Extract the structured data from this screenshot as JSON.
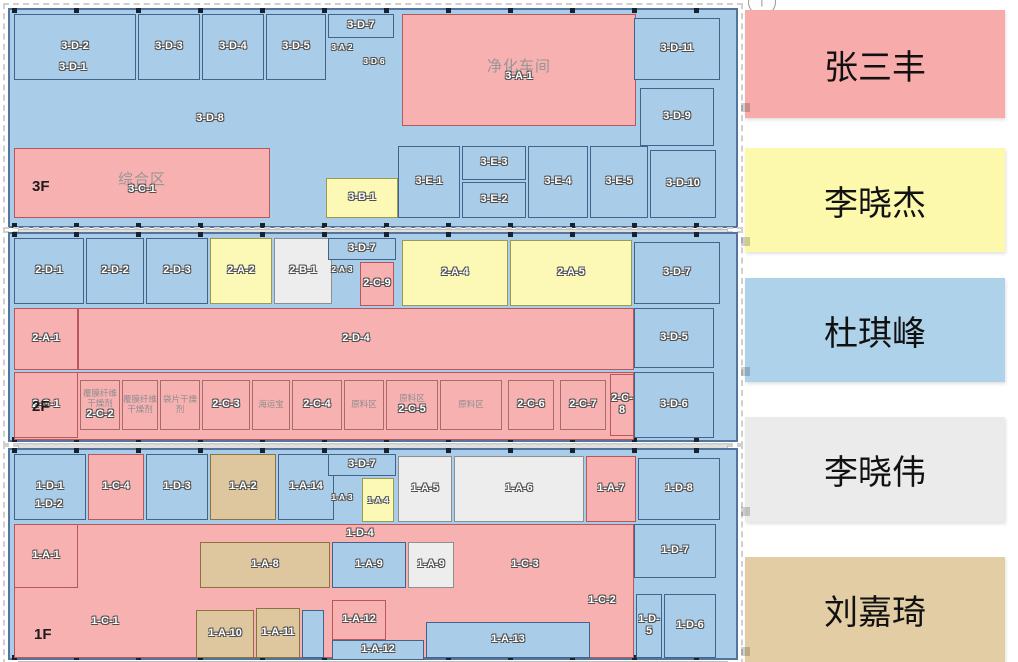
{
  "colors": {
    "pink": {
      "bg": "#f8b1b1",
      "border": "#b5575d"
    },
    "yellow": {
      "bg": "#fbf9b5",
      "border": "#9b9b4f"
    },
    "blue": {
      "bg": "#a9cde9",
      "border": "#41638c"
    },
    "gray": {
      "bg": "#ededed",
      "border": "#8f8f8f"
    },
    "tan": {
      "bg": "#dec69e",
      "border": "#8b7340"
    },
    "pinkbox": {
      "bg": "#f8b1b1",
      "border": "#a96c6c"
    },
    "floor_base": "#a9cde9",
    "wall": "#53759b"
  },
  "legend": {
    "north_arrow": {
      "icon": "north-arrow",
      "glyph": "↑"
    },
    "items": [
      {
        "name": "张三丰",
        "color": "#f8abab",
        "y": 10,
        "h": 108
      },
      {
        "name": "李晓杰",
        "color": "#fcf9ad",
        "y": 148,
        "h": 104
      },
      {
        "name": "杜琪峰",
        "color": "#aed2ea",
        "y": 278,
        "h": 104
      },
      {
        "name": "李晓伟",
        "color": "#ebebeb",
        "y": 417,
        "h": 105
      },
      {
        "name": "刘嘉琦",
        "color": "#e3cda4",
        "y": 557,
        "h": 105
      }
    ]
  },
  "floors": [
    {
      "id": "3F",
      "label": "3F",
      "x": 8,
      "y": 8,
      "w": 730,
      "h": 220,
      "label_x": 22,
      "label_y": 168,
      "rooms": [
        {
          "label": "3-A-1",
          "color": "pink",
          "x": 392,
          "y": 4,
          "w": 234,
          "h": 112,
          "ann": "净化车间",
          "annBig": true
        },
        {
          "label": "3-C-1",
          "color": "pink",
          "x": 4,
          "y": 138,
          "w": 256,
          "h": 70,
          "ann": "综合区",
          "annBig": true
        },
        {
          "label": "3-D-2",
          "color": "blue",
          "x": 4,
          "y": 4,
          "w": 122,
          "h": 66
        },
        {
          "label": "3-D-1",
          "color": "none",
          "x": 18,
          "y": 50,
          "w": 90,
          "h": 16
        },
        {
          "label": "3-D-3",
          "color": "blue",
          "x": 128,
          "y": 4,
          "w": 62,
          "h": 66
        },
        {
          "label": "3-D-4",
          "color": "blue",
          "x": 192,
          "y": 4,
          "w": 62,
          "h": 66
        },
        {
          "label": "3-D-5",
          "color": "blue",
          "x": 256,
          "y": 4,
          "w": 60,
          "h": 66
        },
        {
          "label": "3-D-7",
          "color": "blue",
          "x": 318,
          "y": 4,
          "w": 66,
          "h": 24
        },
        {
          "label": "3-A-2",
          "color": "none",
          "x": 312,
          "y": 30,
          "w": 40,
          "h": 14,
          "small": true
        },
        {
          "label": "3-D-6",
          "color": "none",
          "x": 344,
          "y": 42,
          "w": 40,
          "h": 18,
          "small": true
        },
        {
          "label": "3-D-11",
          "color": "blue",
          "x": 624,
          "y": 8,
          "w": 86,
          "h": 62
        },
        {
          "label": "3-D-8",
          "color": "none",
          "x": 140,
          "y": 100,
          "w": 120,
          "h": 18
        },
        {
          "label": "3-D-9",
          "color": "blue",
          "x": 630,
          "y": 78,
          "w": 74,
          "h": 58
        },
        {
          "label": "3-B-1",
          "color": "yellow",
          "x": 316,
          "y": 168,
          "w": 72,
          "h": 40
        },
        {
          "label": "3-E-1",
          "color": "blue",
          "x": 388,
          "y": 136,
          "w": 62,
          "h": 72
        },
        {
          "label": "3-E-3",
          "color": "blue",
          "x": 452,
          "y": 136,
          "w": 64,
          "h": 34
        },
        {
          "label": "3-E-2",
          "color": "blue",
          "x": 452,
          "y": 172,
          "w": 64,
          "h": 36
        },
        {
          "label": "3-E-4",
          "color": "blue",
          "x": 518,
          "y": 136,
          "w": 60,
          "h": 72
        },
        {
          "label": "3-E-5",
          "color": "blue",
          "x": 580,
          "y": 136,
          "w": 58,
          "h": 72
        },
        {
          "label": "3-D-10",
          "color": "blue",
          "x": 640,
          "y": 140,
          "w": 66,
          "h": 68
        }
      ]
    },
    {
      "id": "2F",
      "label": "2F",
      "x": 8,
      "y": 232,
      "w": 730,
      "h": 210,
      "label_x": 22,
      "label_y": 164,
      "rooms": [
        {
          "label": "",
          "color": "pink",
          "x": 4,
          "y": 74,
          "w": 620,
          "h": 62
        },
        {
          "label": "",
          "color": "pink",
          "x": 4,
          "y": 138,
          "w": 620,
          "h": 68
        },
        {
          "label": "2-D-1",
          "color": "blue",
          "x": 4,
          "y": 4,
          "w": 70,
          "h": 66
        },
        {
          "label": "2-D-2",
          "color": "blue",
          "x": 76,
          "y": 4,
          "w": 58,
          "h": 66
        },
        {
          "label": "2-D-3",
          "color": "blue",
          "x": 136,
          "y": 4,
          "w": 62,
          "h": 66
        },
        {
          "label": "2-A-2",
          "color": "yellow",
          "x": 200,
          "y": 4,
          "w": 62,
          "h": 66
        },
        {
          "label": "2-B-1",
          "color": "gray",
          "x": 264,
          "y": 4,
          "w": 58,
          "h": 66
        },
        {
          "label": "3-D-7",
          "color": "blue",
          "x": 318,
          "y": 4,
          "w": 68,
          "h": 22
        },
        {
          "label": "2-A-3",
          "color": "none",
          "x": 314,
          "y": 28,
          "w": 36,
          "h": 14,
          "small": true
        },
        {
          "label": "2-C-9",
          "color": "pink",
          "x": 350,
          "y": 28,
          "w": 34,
          "h": 44
        },
        {
          "label": "2-A-4",
          "color": "yellow",
          "x": 392,
          "y": 6,
          "w": 106,
          "h": 66
        },
        {
          "label": "2-A-5",
          "color": "yellow",
          "x": 500,
          "y": 6,
          "w": 122,
          "h": 66
        },
        {
          "label": "3-D-7",
          "color": "blue",
          "x": 624,
          "y": 8,
          "w": 86,
          "h": 62
        },
        {
          "label": "2-A-1",
          "color": "pink",
          "x": 4,
          "y": 74,
          "w": 64,
          "h": 62
        },
        {
          "label": "2-D-4",
          "color": "pink",
          "x": 68,
          "y": 74,
          "w": 556,
          "h": 62
        },
        {
          "label": "3-D-5",
          "color": "blue",
          "x": 624,
          "y": 74,
          "w": 80,
          "h": 60
        },
        {
          "label": "2-C-1",
          "color": "pink",
          "x": 4,
          "y": 138,
          "w": 64,
          "h": 66
        },
        {
          "label": "2-C-2",
          "color": "pinkbox",
          "x": 70,
          "y": 146,
          "w": 40,
          "h": 50,
          "ann": "覆膜纤维干燥剂"
        },
        {
          "label": "",
          "color": "pinkbox",
          "x": 112,
          "y": 146,
          "w": 36,
          "h": 50,
          "ann": "覆膜纤维干燥剂"
        },
        {
          "label": "",
          "color": "pinkbox",
          "x": 150,
          "y": 146,
          "w": 40,
          "h": 50,
          "ann": "袋片干燥剂"
        },
        {
          "label": "2-C-3",
          "color": "pinkbox",
          "x": 192,
          "y": 146,
          "w": 48,
          "h": 50
        },
        {
          "label": "",
          "color": "pinkbox",
          "x": 242,
          "y": 146,
          "w": 38,
          "h": 50,
          "ann": "海运宝"
        },
        {
          "label": "2-C-4",
          "color": "pinkbox",
          "x": 282,
          "y": 146,
          "w": 50,
          "h": 50
        },
        {
          "label": "",
          "color": "pinkbox",
          "x": 334,
          "y": 146,
          "w": 40,
          "h": 50,
          "ann": "原料区"
        },
        {
          "label": "2-C-5",
          "color": "pinkbox",
          "x": 376,
          "y": 146,
          "w": 52,
          "h": 50,
          "ann": "原料区"
        },
        {
          "label": "",
          "color": "pinkbox",
          "x": 430,
          "y": 146,
          "w": 62,
          "h": 50,
          "ann": "原料区"
        },
        {
          "label": "2-C-6",
          "color": "pinkbox",
          "x": 498,
          "y": 146,
          "w": 46,
          "h": 50
        },
        {
          "label": "2-C-7",
          "color": "pinkbox",
          "x": 550,
          "y": 146,
          "w": 46,
          "h": 50
        },
        {
          "label": "2-C-8",
          "color": "pink",
          "x": 600,
          "y": 140,
          "w": 24,
          "h": 62
        },
        {
          "label": "3-D-6",
          "color": "blue",
          "x": 624,
          "y": 138,
          "w": 80,
          "h": 66
        }
      ]
    },
    {
      "id": "1F",
      "label": "1F",
      "x": 8,
      "y": 448,
      "w": 730,
      "h": 212,
      "label_x": 24,
      "label_y": 176,
      "rooms": [
        {
          "label": "",
          "color": "pink",
          "x": 4,
          "y": 74,
          "w": 620,
          "h": 134
        },
        {
          "label": "1-D-1",
          "color": "blue",
          "x": 4,
          "y": 4,
          "w": 72,
          "h": 66
        },
        {
          "label": "1-D-2",
          "color": "none",
          "x": 8,
          "y": 46,
          "w": 62,
          "h": 18
        },
        {
          "label": "1-C-4",
          "color": "pink",
          "x": 78,
          "y": 4,
          "w": 56,
          "h": 66
        },
        {
          "label": "1-D-3",
          "color": "blue",
          "x": 136,
          "y": 4,
          "w": 62,
          "h": 66
        },
        {
          "label": "1-A-2",
          "color": "tan",
          "x": 200,
          "y": 4,
          "w": 66,
          "h": 66
        },
        {
          "label": "1-A-14",
          "color": "blue",
          "x": 268,
          "y": 4,
          "w": 56,
          "h": 66
        },
        {
          "label": "3-D-7",
          "color": "blue",
          "x": 318,
          "y": 4,
          "w": 68,
          "h": 22
        },
        {
          "label": "1-A-3",
          "color": "none",
          "x": 314,
          "y": 40,
          "w": 36,
          "h": 14,
          "small": true
        },
        {
          "label": "1-A-4",
          "color": "yellow",
          "x": 352,
          "y": 28,
          "w": 32,
          "h": 44,
          "small": true
        },
        {
          "label": "1-A-5",
          "color": "gray",
          "x": 388,
          "y": 6,
          "w": 54,
          "h": 66
        },
        {
          "label": "1-A-6",
          "color": "gray",
          "x": 444,
          "y": 6,
          "w": 130,
          "h": 66
        },
        {
          "label": "1-A-7",
          "color": "pink",
          "x": 576,
          "y": 6,
          "w": 50,
          "h": 66
        },
        {
          "label": "1-D-8",
          "color": "blue",
          "x": 628,
          "y": 8,
          "w": 82,
          "h": 62
        },
        {
          "label": "1-D-4",
          "color": "none",
          "x": 300,
          "y": 76,
          "w": 100,
          "h": 16
        },
        {
          "label": "1-A-1",
          "color": "pink",
          "x": 4,
          "y": 74,
          "w": 64,
          "h": 64
        },
        {
          "label": "1-A-8",
          "color": "tan",
          "x": 190,
          "y": 92,
          "w": 130,
          "h": 46
        },
        {
          "label": "1-A-9",
          "color": "blue",
          "x": 322,
          "y": 92,
          "w": 74,
          "h": 46
        },
        {
          "label": "1-A-9",
          "color": "gray",
          "x": 398,
          "y": 92,
          "w": 46,
          "h": 46
        },
        {
          "label": "1-C-3",
          "color": "none",
          "x": 460,
          "y": 100,
          "w": 110,
          "h": 30
        },
        {
          "label": "1-D-7",
          "color": "blue",
          "x": 624,
          "y": 74,
          "w": 82,
          "h": 54
        },
        {
          "label": "1-C-1",
          "color": "none",
          "x": 40,
          "y": 162,
          "w": 110,
          "h": 20
        },
        {
          "label": "1-A-10",
          "color": "tan",
          "x": 186,
          "y": 160,
          "w": 58,
          "h": 48
        },
        {
          "label": "1-A-11",
          "color": "tan",
          "x": 246,
          "y": 158,
          "w": 44,
          "h": 50
        },
        {
          "label": "",
          "color": "blue",
          "x": 292,
          "y": 160,
          "w": 22,
          "h": 48
        },
        {
          "label": "1-A-12",
          "color": "pink",
          "x": 322,
          "y": 150,
          "w": 54,
          "h": 40
        },
        {
          "label": "1-A-12",
          "color": "blue",
          "x": 322,
          "y": 190,
          "w": 92,
          "h": 20
        },
        {
          "label": "1-A-13",
          "color": "blue",
          "x": 416,
          "y": 172,
          "w": 164,
          "h": 36
        },
        {
          "label": "1-C-2",
          "color": "none",
          "x": 562,
          "y": 142,
          "w": 60,
          "h": 18
        },
        {
          "label": "1-D-5",
          "color": "blue",
          "x": 626,
          "y": 144,
          "w": 26,
          "h": 64
        },
        {
          "label": "1-D-6",
          "color": "blue",
          "x": 654,
          "y": 144,
          "w": 52,
          "h": 64
        }
      ]
    }
  ]
}
